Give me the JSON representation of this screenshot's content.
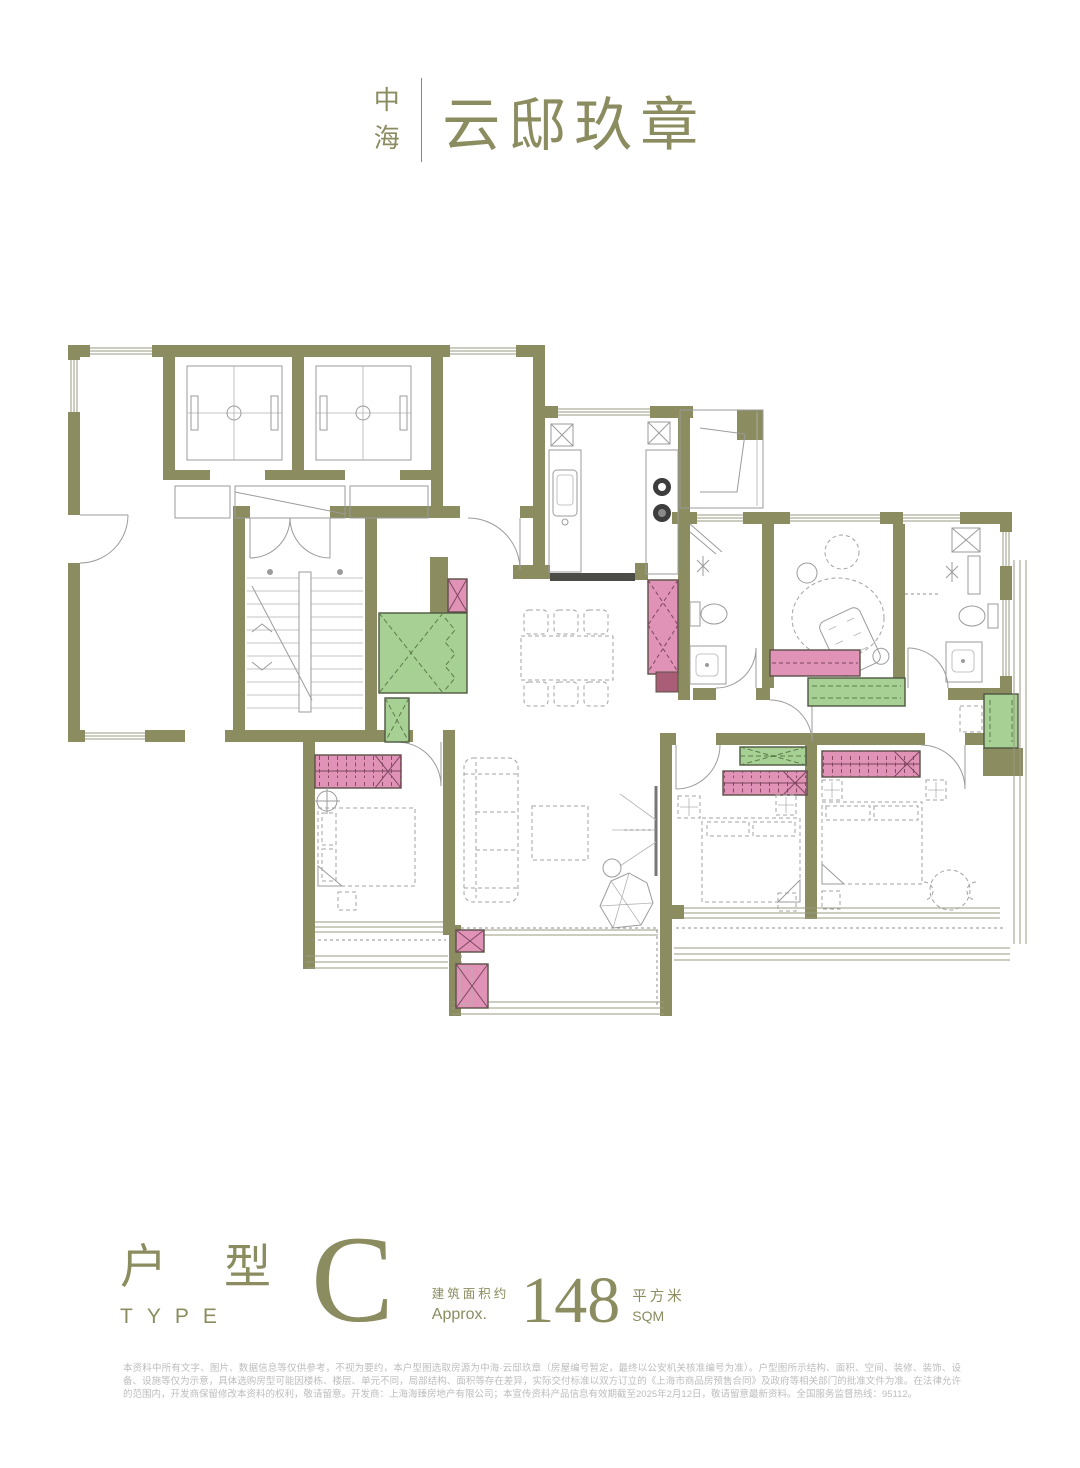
{
  "logo": {
    "brand_stacked": [
      "中",
      "海"
    ],
    "name": "云邸玖章"
  },
  "type_block": {
    "label_zh": "户 型",
    "label_en": "TYPE",
    "letter": "C",
    "area_prefix_zh": "建筑面积约",
    "area_prefix_en": "Approx.",
    "area_value": "148",
    "area_unit_zh": "平方米",
    "area_unit_en": "SQM"
  },
  "disclaimer": "本资料中所有文字、图片、数据信息等仅供参考，不视为要约，本户型图选取房源为中海·云邸玖章（房屋编号暂定，最终以公安机关核准编号为准）。户型图所示结构、面积、空间、装修、装饰、设备、设施等仅为示意，具体选购房型可能因楼栋、楼层、单元不同，局部结构、面积等存在差异，实际交付标准以双方订立的《上海市商品房预售合同》及政府等相关部门的批准文件为准。在法律允许的范围内，开发商保留修改本资料的权利，敬请留意。开发商：上海海臻房地产有限公司；本宣传资料产品信息有效期截至2025年2月12日，敬请留意最新资料。全国服务监督热线：95112。",
  "floor_plan": {
    "type_letter": "C",
    "colors": {
      "wall_olive": "#8b8c5f",
      "furniture_pink": "#e093b6",
      "furniture_pink_dark": "#aa5d76",
      "furniture_green": "#a7d194",
      "line_gray": "#9b9b9b",
      "text_olive": "#8b8c5f",
      "disclaimer_gray": "#bdbdbd"
    }
  }
}
